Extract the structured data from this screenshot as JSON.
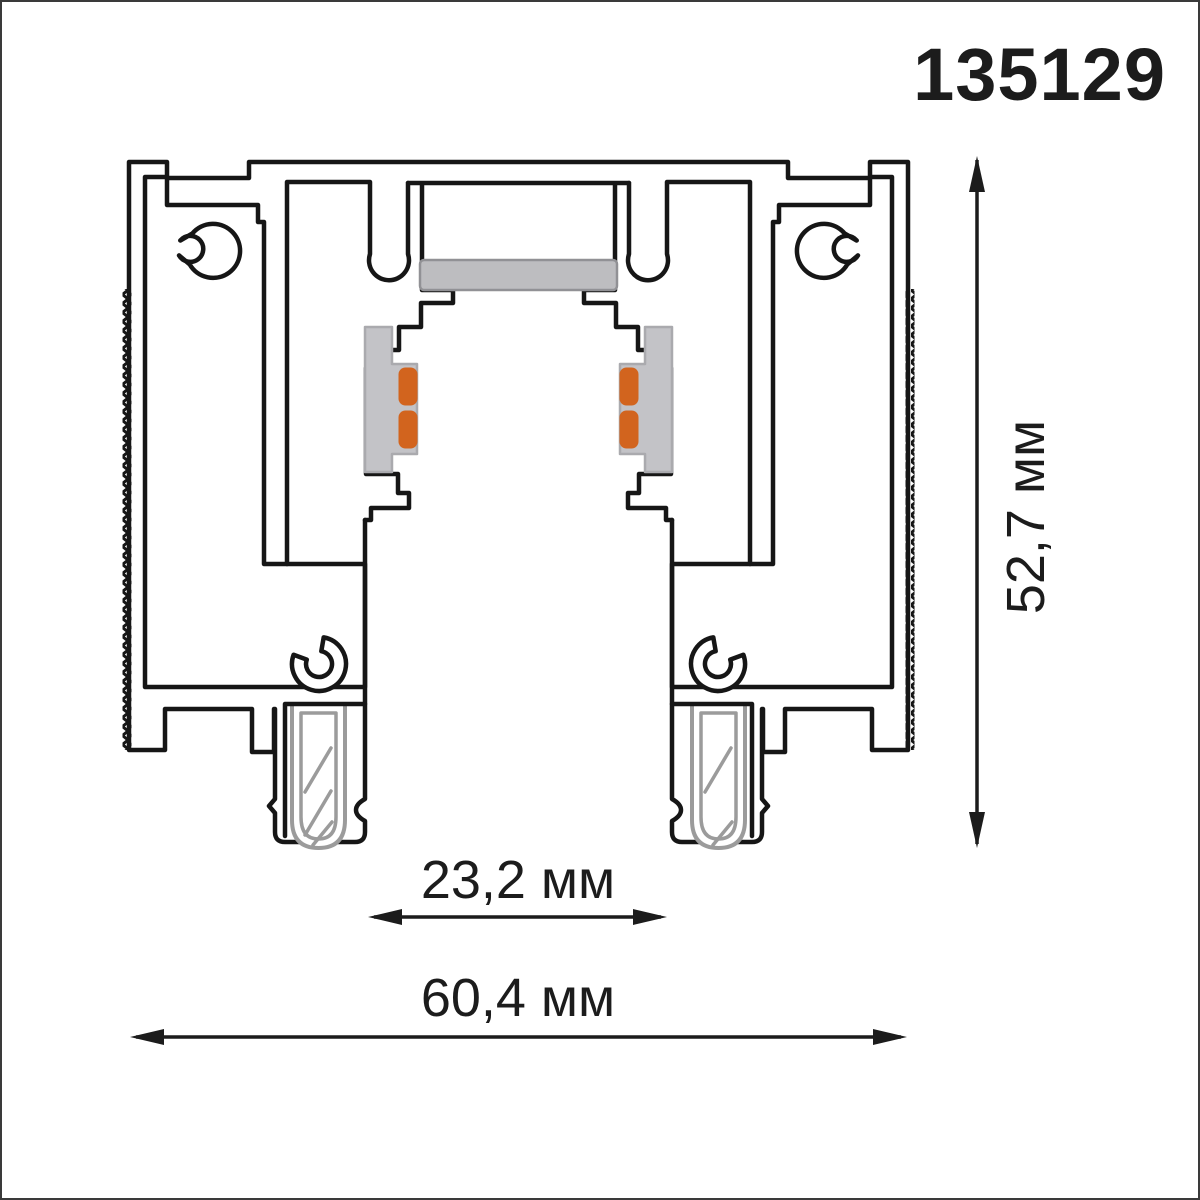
{
  "title": {
    "part_number": "135129"
  },
  "dimensions": {
    "height": {
      "label": "52,7 мм"
    },
    "slot_width": {
      "label": "23,2 мм"
    },
    "overall_width": {
      "label": "60,4 мм"
    }
  },
  "colors": {
    "outline": "#161616",
    "copper": "#d2641e",
    "insulator": "#c3c3c7",
    "strip": "#bdbdc0",
    "clip": "#9b9b9b",
    "text": "#1c1c1c"
  }
}
